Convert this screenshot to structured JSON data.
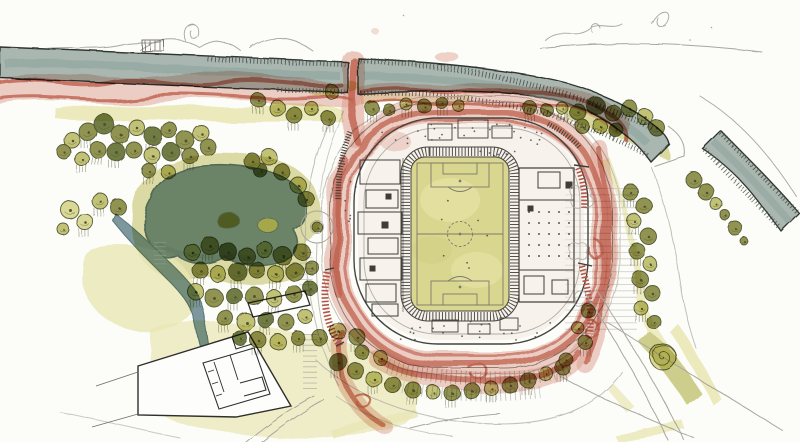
{
  "scene": {
    "kind": "hand-drawn watercolor masterplan site sketch",
    "elements": [
      "highway",
      "stadium",
      "football-pitch",
      "pond",
      "stream",
      "tree-clusters",
      "red-pedestrian-circulation",
      "building-complex",
      "access-roads"
    ]
  },
  "palette": {
    "paper": "#fcfcf8",
    "ink": "#3e3d38",
    "pencil": "#a8a69e",
    "road": "#a9b7b0",
    "roadDark": "#8ba29a",
    "roadEdge": "#2f3430",
    "red": "#c2604f",
    "redLight": "#e0a193",
    "pitch": "#d9d68f",
    "pitchLight": "#e9e6aa",
    "pond": "#7d9aa2",
    "pondEdge": "#5e7c84",
    "olive": "#8e9048",
    "oliveDark": "#6b763c",
    "oliveLight": "#c2c272",
    "olivePale": "#dbda94",
    "grassPale": "#eceab9",
    "grassMid": "#d6d593",
    "treeInk": "#4f5430",
    "hatch": "#8a8874"
  },
  "trees": [
    [
      72,
      140,
      8,
      "l",
      0
    ],
    [
      88,
      132,
      9,
      "o",
      1
    ],
    [
      104,
      124,
      10,
      "d",
      0
    ],
    [
      120,
      134,
      9,
      "o",
      1
    ],
    [
      137,
      128,
      8,
      "l",
      0
    ],
    [
      153,
      136,
      9,
      "d",
      1
    ],
    [
      169,
      130,
      8,
      "o",
      0
    ],
    [
      185,
      140,
      9,
      "o",
      1
    ],
    [
      201,
      133,
      8,
      "l",
      0
    ],
    [
      98,
      150,
      8,
      "o",
      1
    ],
    [
      116,
      152,
      9,
      "d",
      1
    ],
    [
      134,
      150,
      8,
      "o",
      0
    ],
    [
      152,
      155,
      8,
      "l",
      1
    ],
    [
      171,
      152,
      9,
      "d",
      0
    ],
    [
      190,
      156,
      8,
      "o",
      1
    ],
    [
      208,
      147,
      8,
      "o",
      0
    ],
    [
      82,
      159,
      7,
      "l",
      1
    ],
    [
      64,
      152,
      7,
      "o",
      0
    ],
    [
      148,
      170,
      7,
      "o",
      1
    ],
    [
      168,
      172,
      7,
      "l",
      0
    ],
    [
      70,
      210,
      9,
      "p",
      0
    ],
    [
      85,
      222,
      8,
      "p",
      1
    ],
    [
      63,
      229,
      6,
      "l",
      0
    ],
    [
      100,
      201,
      8,
      "l",
      1
    ],
    [
      118,
      207,
      8,
      "o",
      0
    ],
    [
      260,
      170,
      7,
      "d",
      0
    ],
    [
      282,
      172,
      8,
      "o",
      0
    ],
    [
      298,
      185,
      8,
      "l",
      0
    ],
    [
      306,
      199,
      8,
      "o",
      0
    ],
    [
      252,
      161,
      8,
      "o",
      0
    ],
    [
      269,
      157,
      8,
      "l",
      0
    ],
    [
      258,
      100,
      7,
      "o",
      1
    ],
    [
      277,
      108,
      8,
      "l",
      0
    ],
    [
      294,
      115,
      8,
      "o",
      1
    ],
    [
      312,
      109,
      7,
      "l",
      0
    ],
    [
      328,
      118,
      7,
      "o",
      1
    ],
    [
      332,
      92,
      7,
      "l",
      0
    ],
    [
      372,
      108,
      7,
      "o",
      1
    ],
    [
      389,
      110,
      6,
      "o",
      0
    ],
    [
      406,
      104,
      6,
      "l",
      1
    ],
    [
      424,
      106,
      7,
      "o",
      0
    ],
    [
      442,
      103,
      6,
      "o",
      1
    ],
    [
      459,
      106,
      6,
      "l",
      0
    ],
    [
      530,
      108,
      7,
      "o",
      1
    ],
    [
      547,
      110,
      6,
      "o",
      0
    ],
    [
      562,
      108,
      6,
      "l",
      1
    ],
    [
      578,
      112,
      8,
      "o",
      0
    ],
    [
      596,
      106,
      9,
      "d",
      0
    ],
    [
      613,
      113,
      8,
      "o",
      0
    ],
    [
      629,
      108,
      8,
      "o",
      0
    ],
    [
      645,
      117,
      8,
      "l",
      0
    ],
    [
      657,
      128,
      8,
      "o",
      0
    ],
    [
      600,
      126,
      7,
      "l",
      0
    ],
    [
      582,
      126,
      7,
      "o",
      0
    ],
    [
      616,
      130,
      7,
      "d",
      0
    ],
    [
      694,
      180,
      8,
      "o",
      0
    ],
    [
      706,
      192,
      8,
      "o",
      0
    ],
    [
      716,
      204,
      6,
      "l",
      0
    ],
    [
      725,
      215,
      5,
      "o",
      0
    ],
    [
      735,
      228,
      7,
      "o",
      0
    ],
    [
      744,
      241,
      4,
      "o",
      0
    ],
    [
      630,
      192,
      8,
      "o",
      1
    ],
    [
      644,
      206,
      8,
      "o",
      0
    ],
    [
      634,
      221,
      7,
      "l",
      1
    ],
    [
      648,
      236,
      8,
      "o",
      0
    ],
    [
      637,
      251,
      8,
      "o",
      1
    ],
    [
      650,
      264,
      7,
      "l",
      0
    ],
    [
      640,
      279,
      8,
      "o",
      1
    ],
    [
      652,
      293,
      8,
      "o",
      0
    ],
    [
      641,
      308,
      7,
      "l",
      1
    ],
    [
      654,
      322,
      7,
      "o",
      0
    ],
    [
      192,
      252,
      8,
      "l",
      0
    ],
    [
      210,
      246,
      9,
      "o",
      1
    ],
    [
      228,
      252,
      9,
      "d",
      0
    ],
    [
      247,
      256,
      8,
      "o",
      1
    ],
    [
      265,
      250,
      8,
      "l",
      0
    ],
    [
      283,
      256,
      9,
      "o",
      1
    ],
    [
      302,
      252,
      8,
      "o",
      0
    ],
    [
      200,
      270,
      8,
      "o",
      1
    ],
    [
      218,
      274,
      8,
      "l",
      0
    ],
    [
      238,
      272,
      9,
      "d",
      1
    ],
    [
      257,
      270,
      8,
      "o",
      0
    ],
    [
      276,
      274,
      8,
      "l",
      1
    ],
    [
      295,
      272,
      9,
      "o",
      0
    ],
    [
      312,
      268,
      7,
      "o",
      0
    ],
    [
      196,
      292,
      8,
      "l",
      1
    ],
    [
      214,
      298,
      9,
      "o",
      0
    ],
    [
      234,
      296,
      8,
      "d",
      1
    ],
    [
      254,
      296,
      9,
      "o",
      0
    ],
    [
      274,
      298,
      8,
      "l",
      1
    ],
    [
      294,
      294,
      8,
      "o",
      0
    ],
    [
      310,
      288,
      7,
      "d",
      0
    ],
    [
      225,
      318,
      8,
      "o",
      1
    ],
    [
      246,
      322,
      9,
      "l",
      0
    ],
    [
      266,
      320,
      8,
      "d",
      1
    ],
    [
      286,
      322,
      8,
      "o",
      0
    ],
    [
      305,
      316,
      7,
      "l",
      0
    ],
    [
      258,
      340,
      8,
      "o",
      1
    ],
    [
      278,
      342,
      8,
      "l",
      0
    ],
    [
      298,
      338,
      7,
      "o",
      1
    ],
    [
      240,
      338,
      7,
      "d",
      0
    ],
    [
      320,
      338,
      8,
      "o",
      0
    ],
    [
      338,
      331,
      8,
      "l",
      0
    ],
    [
      357,
      337,
      8,
      "o",
      1
    ],
    [
      362,
      352,
      7,
      "o",
      0
    ],
    [
      381,
      358,
      7,
      "l",
      0
    ],
    [
      338,
      362,
      9,
      "d",
      1
    ],
    [
      356,
      371,
      8,
      "o",
      0
    ],
    [
      374,
      379,
      8,
      "l",
      1
    ],
    [
      393,
      385,
      8,
      "o",
      0
    ],
    [
      413,
      390,
      8,
      "o",
      1
    ],
    [
      433,
      392,
      7,
      "l",
      0
    ],
    [
      452,
      393,
      8,
      "o",
      1
    ],
    [
      472,
      391,
      8,
      "o",
      0
    ],
    [
      491,
      388,
      7,
      "l",
      1
    ],
    [
      510,
      385,
      8,
      "o",
      0
    ],
    [
      528,
      380,
      8,
      "o",
      1
    ],
    [
      546,
      374,
      7,
      "l",
      0
    ],
    [
      563,
      367,
      8,
      "o",
      1
    ],
    [
      588,
      311,
      7,
      "o",
      0
    ],
    [
      585,
      342,
      7,
      "o",
      1
    ],
    [
      566,
      360,
      7,
      "o",
      0
    ],
    [
      578,
      328,
      6,
      "l",
      0
    ],
    [
      663,
      357,
      13,
      "s",
      0
    ],
    [
      317,
      227,
      5,
      "o",
      0
    ]
  ],
  "stadium": {
    "dot_fields": [
      {
        "x": 378,
        "y": 124,
        "w": 170,
        "h": 22,
        "n": 26,
        "seed": 3
      },
      {
        "x": 388,
        "y": 320,
        "w": 164,
        "h": 20,
        "n": 22,
        "seed": 9
      },
      {
        "x": 344,
        "y": 152,
        "w": 12,
        "h": 78,
        "n": 8,
        "seed": 5
      },
      {
        "x": 472,
        "y": 150,
        "w": 60,
        "h": 8,
        "n": 6,
        "seed": 2
      },
      {
        "x": 430,
        "y": 192,
        "w": 60,
        "h": 84,
        "n": 7,
        "seed": 11
      }
    ],
    "east_wing_grid": {
      "x0": 529,
      "y0": 212,
      "cols": 5,
      "dx": 10,
      "rows": 5,
      "dy": 11
    }
  }
}
